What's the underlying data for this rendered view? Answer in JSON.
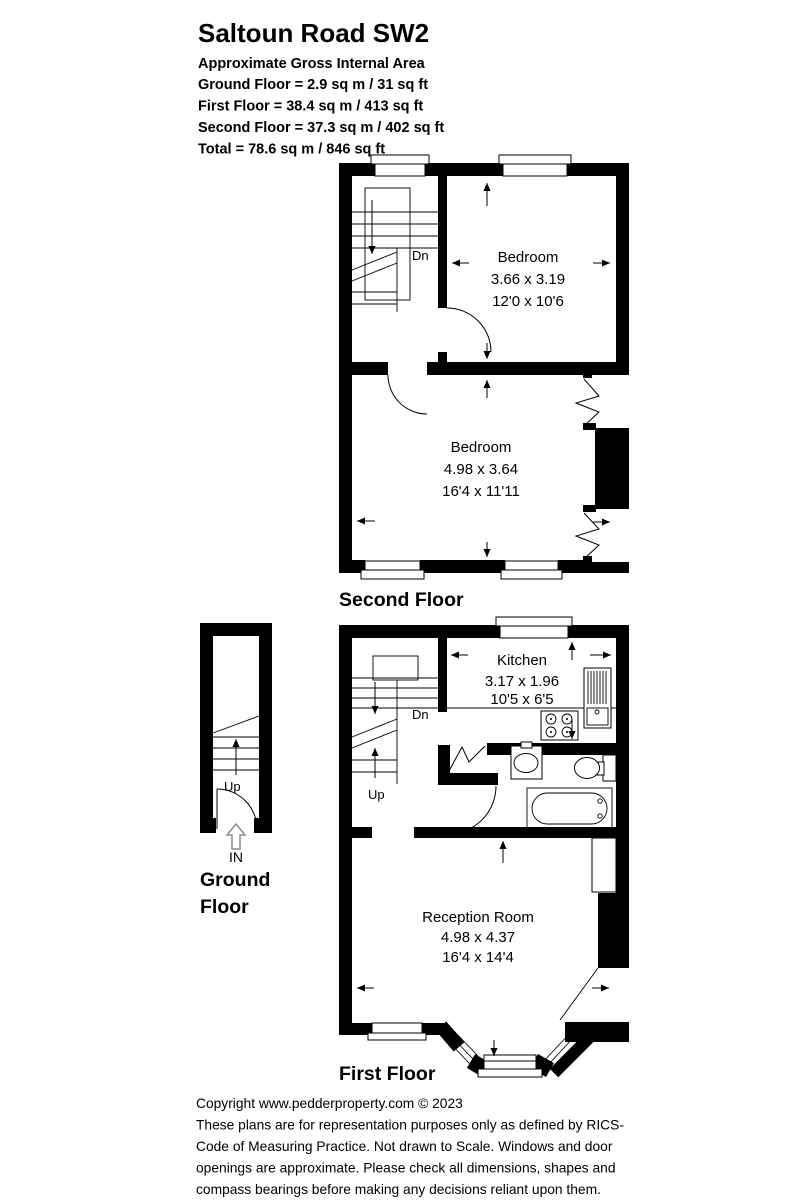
{
  "header": {
    "title": "Saltoun Road SW2",
    "subtitle": "Approximate Gross Internal Area",
    "areas": [
      "Ground Floor = 2.9 sq m / 31 sq ft",
      "First Floor = 38.4 sq m / 413 sq ft",
      "Second Floor = 37.3 sq m / 402 sq ft",
      "Total = 78.6 sq m / 846 sq ft"
    ]
  },
  "floors": {
    "second": {
      "label": "Second Floor",
      "stair_down": "Dn",
      "rooms": [
        {
          "name": "Bedroom",
          "metric": "3.66 x 3.19",
          "imperial": "12'0 x 10'6"
        },
        {
          "name": "Bedroom",
          "metric": "4.98 x 3.64",
          "imperial": "16'4 x 11'11"
        }
      ]
    },
    "first": {
      "label": "First Floor",
      "stair_down": "Dn",
      "stair_up": "Up",
      "rooms": [
        {
          "name": "Kitchen",
          "metric": "3.17 x 1.96",
          "imperial": "10'5 x 6'5"
        },
        {
          "name": "Reception Room",
          "metric": "4.98 x 4.37",
          "imperial": "16'4 x 14'4"
        }
      ]
    },
    "ground": {
      "label_lines": [
        "Ground",
        "Floor"
      ],
      "stair_up": "Up",
      "entrance": "IN"
    }
  },
  "footer": {
    "lines": [
      "Copyright www.pedderproperty.com © 2023",
      "These plans are for representation purposes only as defined by RICS-",
      "Code of Measuring Practice. Not drawn to Scale. Windows and door",
      "openings are approximate. Please check all dimensions, shapes and",
      "compass bearings before making any decisions reliant upon them."
    ]
  },
  "colors": {
    "wall": "#000000",
    "background": "#ffffff",
    "entrance_arrow": "#8a8a8a"
  }
}
